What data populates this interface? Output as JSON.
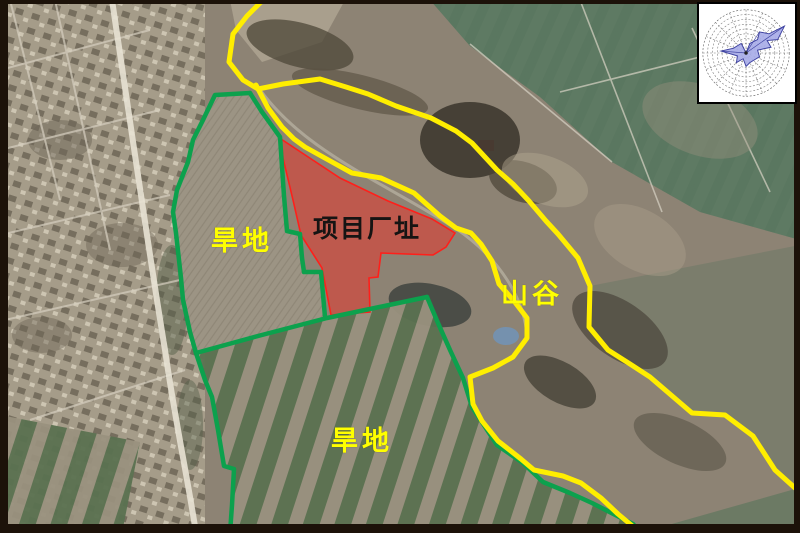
{
  "map": {
    "kind": "satellite-annotation-map",
    "labels": {
      "dryland_upper": "旱地",
      "project_site": "项目厂址",
      "valley": "山谷",
      "dryland_lower": "旱地"
    },
    "colors": {
      "boundary_green": "#0ca14d",
      "route_yellow": "#ffee00",
      "site_fill": "#e8362e",
      "site_stroke": "#ff1f1a",
      "label_yellow": "#ffff00",
      "label_dark": "#161413",
      "frame": "#1c1209",
      "windrose_fill": "#a8ade8",
      "windrose_stroke": "#3d41a0"
    },
    "overlays": {
      "yellow_outer": "263,0 247,16 233,34 229,62 243,80 258,89 283,84 320,79 346,87 368,94 396,106 431,118 456,131 472,143 497,170 513,184 529,201 546,221 558,234 578,258 590,286 589,327 608,350 630,364 650,377 692,413 725,415 753,436 775,470 795,488",
      "yellow_inner": "256,85 268,108 282,127 294,139 305,147 332,162 352,173 381,178 414,193 440,216 456,228 471,233 481,244 492,261 499,284 514,301 527,318 527,338 513,357 493,368 470,377 473,404 482,421 498,441 521,459 534,470 563,476 581,483 601,498 618,514 636,529 639,533",
      "green_outer_west": "250,93 215,95 203,120 193,140 188,162 177,190 173,212 176,233 181,278 183,300 190,332 196,353",
      "green_inner_east": "250,93 262,112 280,137 284,196 287,231 300,234 302,258 304,272 321,272 325,317",
      "green_divider": "196,353 258,336 327,318 427,297",
      "green_southeast": "427,297 438,323 450,350 463,378 472,407 497,445 523,463 543,482 570,493 592,503 633,524 641,533",
      "green_southwest": "196,353 205,380 212,397 218,430 224,466 234,469 232,505 230,533",
      "red_site": "281,139 340,178 388,201 432,219 455,233 446,247 433,255 381,253 378,277 369,278 370,312 331,315 322,268 301,235 293,200 283,158"
    },
    "windrose": {
      "ring_count": 9,
      "spoke_count": 16,
      "main_lobe_direction": "NE",
      "rose_points": "49,51 53,41 61,37 63,29 73,31 89,23 82,37 71,38 75,45 61,48 63,55 53,61 49,65 46,57 39,61 40,54 23,49 36,46 44,41"
    }
  }
}
